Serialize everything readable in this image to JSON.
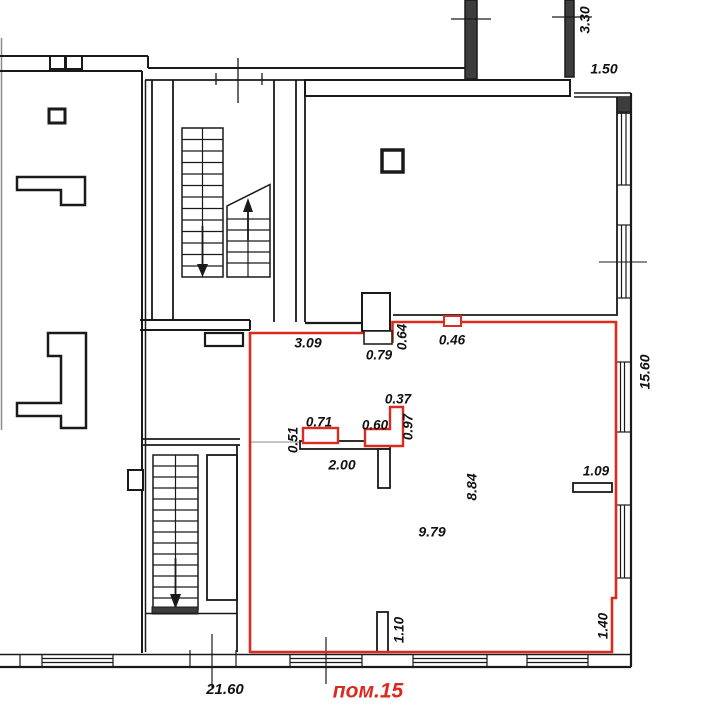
{
  "page": {
    "type": "architectural-floor-plan"
  },
  "colors": {
    "walls": "#1a1a1a",
    "highlight_red": "#d92b1f",
    "wall_fill_dark": "#3d3d3d",
    "faint_line": "#b0b0b0"
  },
  "room": {
    "label": "пом.15"
  },
  "dims": {
    "d330": "3.30",
    "d150": "1.50",
    "d309": "3.09",
    "d079": "0.79",
    "d064": "0.64",
    "d046": "0.46",
    "d1560": "15.60",
    "d037": "0.37",
    "d071": "0.71",
    "d060": "0.60",
    "d097": "0.97",
    "d051": "0.51",
    "d200": "2.00",
    "d884": "8.84",
    "d109": "1.09",
    "d979": "9.79",
    "d110": "1.10",
    "d140": "1.40",
    "d2160": "21.60"
  }
}
